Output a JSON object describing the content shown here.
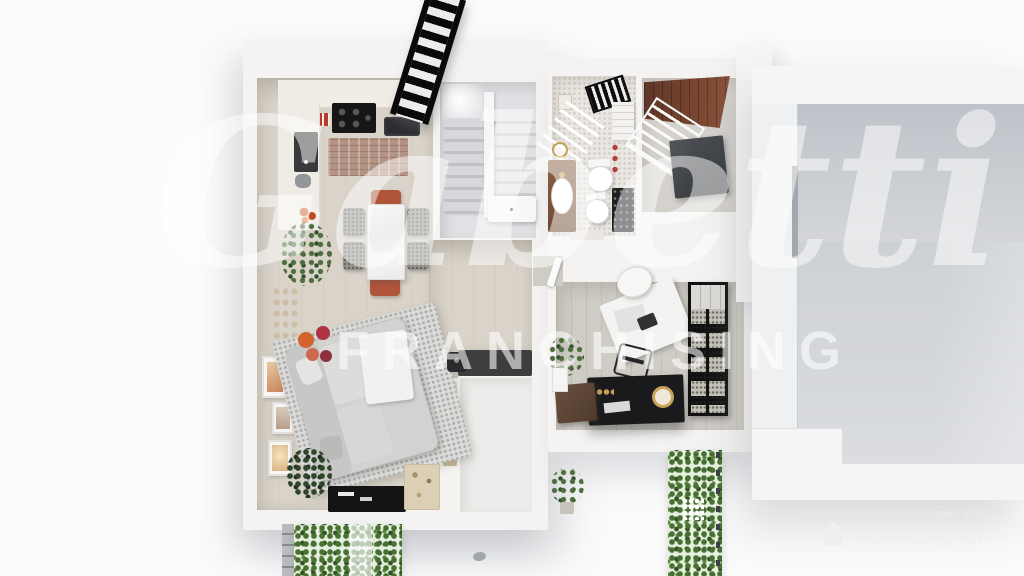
{
  "watermarks": {
    "center_script": "Gabetti",
    "center_caps": "FRANCHISING",
    "corner_caption": "Designed with",
    "corner_brand": "homestyler"
  },
  "palette": {
    "background": "#fbfbfc",
    "walls": "#f4f3f2",
    "main_floor": "#d9d3c9",
    "office_floor": "#cfccc5",
    "right_room_floor": "#ced1d5",
    "stair_treads": "#c6c8cc",
    "terracotta_tile": "#7c4631",
    "hedge_green": "#477032",
    "rug_gray": "#dbdbd9",
    "console_black": "#141414",
    "vanity_wood": "#8a6044",
    "accent_orange": "#d2622e",
    "accent_red": "#b03343",
    "brass_gold": "#c9a158"
  },
  "scene": {
    "view": "top-down 3D floor plan render",
    "rooms": [
      "kitchen-dining",
      "living-room",
      "staircase",
      "bathroom",
      "laundry",
      "home-office",
      "empty-room",
      "garden-strips"
    ]
  }
}
